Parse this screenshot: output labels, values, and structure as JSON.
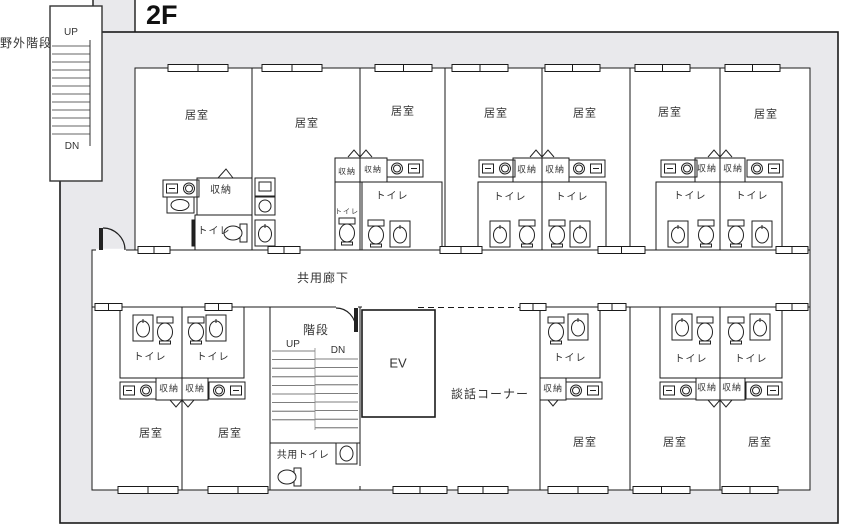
{
  "title": "2F",
  "labels": {
    "outdoor_stairs": "野外階段",
    "up": "UP",
    "dn": "DN",
    "corridor": "共用廊下",
    "stairs": "階段",
    "elevator": "EV",
    "lounge": "談話コーナー",
    "shared_toilet": "共用トイレ",
    "room": "居室",
    "toilet": "トイレ",
    "storage": "収納"
  },
  "colors": {
    "wall": "#e9e9ec",
    "line": "#1a1a1a",
    "floor": "#ffffff"
  },
  "placements": {
    "bedrooms": [
      {
        "x": 197,
        "y": 116
      },
      {
        "x": 307,
        "y": 124
      },
      {
        "x": 403,
        "y": 112
      },
      {
        "x": 496,
        "y": 114
      },
      {
        "x": 585,
        "y": 114
      },
      {
        "x": 670,
        "y": 113
      },
      {
        "x": 766,
        "y": 115
      },
      {
        "x": 151,
        "y": 434
      },
      {
        "x": 230,
        "y": 434
      },
      {
        "x": 585,
        "y": 443
      },
      {
        "x": 675,
        "y": 443
      },
      {
        "x": 760,
        "y": 443
      }
    ],
    "toilets": [
      {
        "x": 214,
        "y": 232,
        "s": 10
      },
      {
        "x": 347,
        "y": 212,
        "s": 7
      },
      {
        "x": 392,
        "y": 197,
        "s": 10
      },
      {
        "x": 510,
        "y": 198,
        "s": 10
      },
      {
        "x": 572,
        "y": 198,
        "s": 10
      },
      {
        "x": 690,
        "y": 197,
        "s": 10
      },
      {
        "x": 752,
        "y": 197,
        "s": 10
      },
      {
        "x": 150,
        "y": 358,
        "s": 10
      },
      {
        "x": 213,
        "y": 358,
        "s": 10
      },
      {
        "x": 570,
        "y": 359,
        "s": 10
      },
      {
        "x": 691,
        "y": 360,
        "s": 10
      },
      {
        "x": 751,
        "y": 360,
        "s": 10
      }
    ],
    "storages": [
      {
        "x": 221,
        "y": 191,
        "s": 10
      },
      {
        "x": 347,
        "y": 172,
        "s": 8
      },
      {
        "x": 373,
        "y": 170,
        "s": 8
      },
      {
        "x": 527,
        "y": 170,
        "s": 9
      },
      {
        "x": 555,
        "y": 170,
        "s": 9
      },
      {
        "x": 707,
        "y": 169,
        "s": 9
      },
      {
        "x": 733,
        "y": 169,
        "s": 9
      },
      {
        "x": 169,
        "y": 389,
        "s": 9
      },
      {
        "x": 195,
        "y": 389,
        "s": 9
      },
      {
        "x": 553,
        "y": 389,
        "s": 9
      },
      {
        "x": 707,
        "y": 388,
        "s": 9
      },
      {
        "x": 732,
        "y": 388,
        "s": 9
      }
    ]
  }
}
